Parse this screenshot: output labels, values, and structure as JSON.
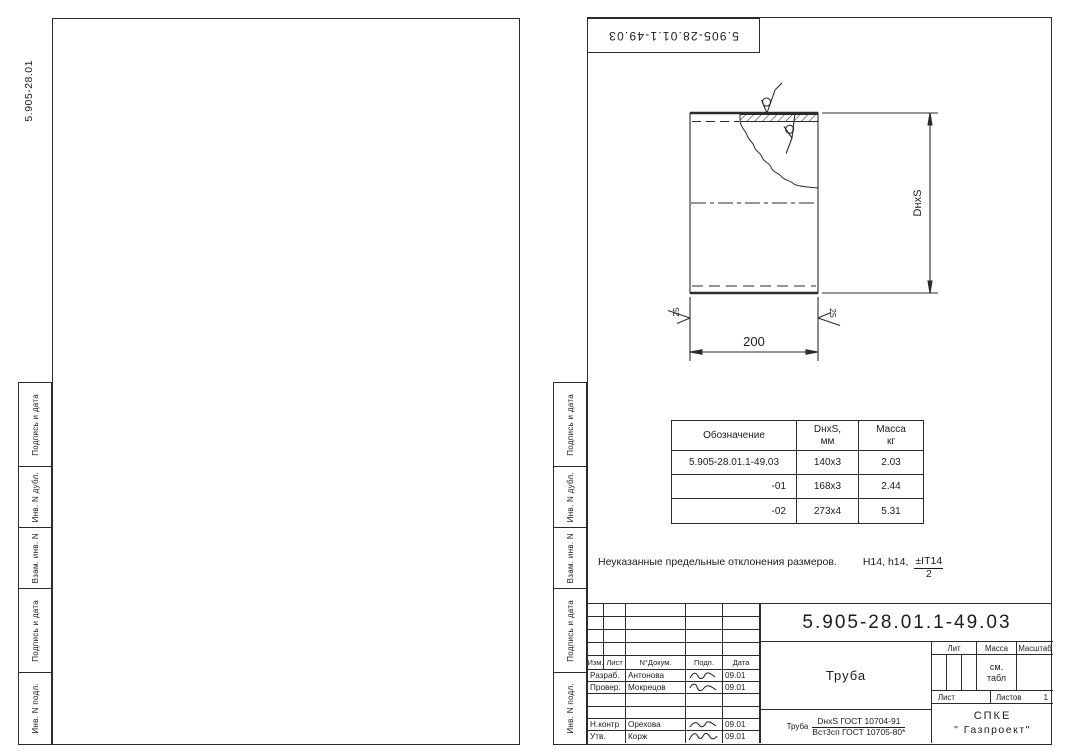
{
  "margin_labels": [
    "Подпись и дата",
    "Инв. N дубл.",
    "Взам. инв. N",
    "Подпись и дата",
    "Инв. N подл."
  ],
  "left_page": {
    "corner_code": "5.905-28.01"
  },
  "right_page": {
    "stamp_code": "5.905-28.01.1-49.03",
    "drawing": {
      "length_dim": "200",
      "size_dim": "DнхS",
      "roughness_left": "25",
      "roughness_right": "25"
    },
    "spec_table": {
      "col1": "Обозначение",
      "col2_line1": "DнхS,",
      "col2_line2": "мм",
      "col3_line1": "Масса",
      "col3_line2": "кг",
      "rows": [
        [
          "5.905-28.01.1-49.03",
          "140х3",
          "2.03"
        ],
        [
          "-01",
          "168х3",
          "2.44"
        ],
        [
          "-02",
          "273х4",
          "5.31"
        ]
      ]
    },
    "note": {
      "text": "Неуказанные предельные отклонения размеров.",
      "tolerance": "Н14, h14,",
      "fraction_num": "±IT14",
      "fraction_den": "2"
    },
    "title_block": {
      "designation": "5.905-28.01.1-49.03",
      "part_name": "Труба",
      "material_prefix": "Труба",
      "material_num": "DнхS ГОСТ 10704-91",
      "material_den": "Вст3сп ГОСТ 10705-80*",
      "col_izm": "Изм.",
      "col_list": "Лист",
      "col_dokum": "N°Докум.",
      "col_podp": "Подп.",
      "col_data": "Дата",
      "sig_rows": [
        {
          "role": "Разраб.",
          "name": "Антонова",
          "date": "09.01"
        },
        {
          "role": "Провер.",
          "name": "Мокрецов",
          "date": "09.01"
        },
        {
          "role": "",
          "name": "",
          "date": ""
        },
        {
          "role": "",
          "name": "",
          "date": ""
        },
        {
          "role": "Н.контр",
          "name": "Орехова",
          "date": "09.01"
        },
        {
          "role": "Утв.",
          "name": "Корж",
          "date": "09.01"
        }
      ],
      "lit_label": "Лит",
      "massa_label": "Масса",
      "masshtab_label": "Масштаб",
      "massa_value_line1": "см.",
      "massa_value_line2": "табл",
      "list_label": "Лист",
      "listov_label": "Листов",
      "listov_value": "1",
      "org_line1": "СПКЕ",
      "org_line2": "\" Газпроект\""
    }
  }
}
